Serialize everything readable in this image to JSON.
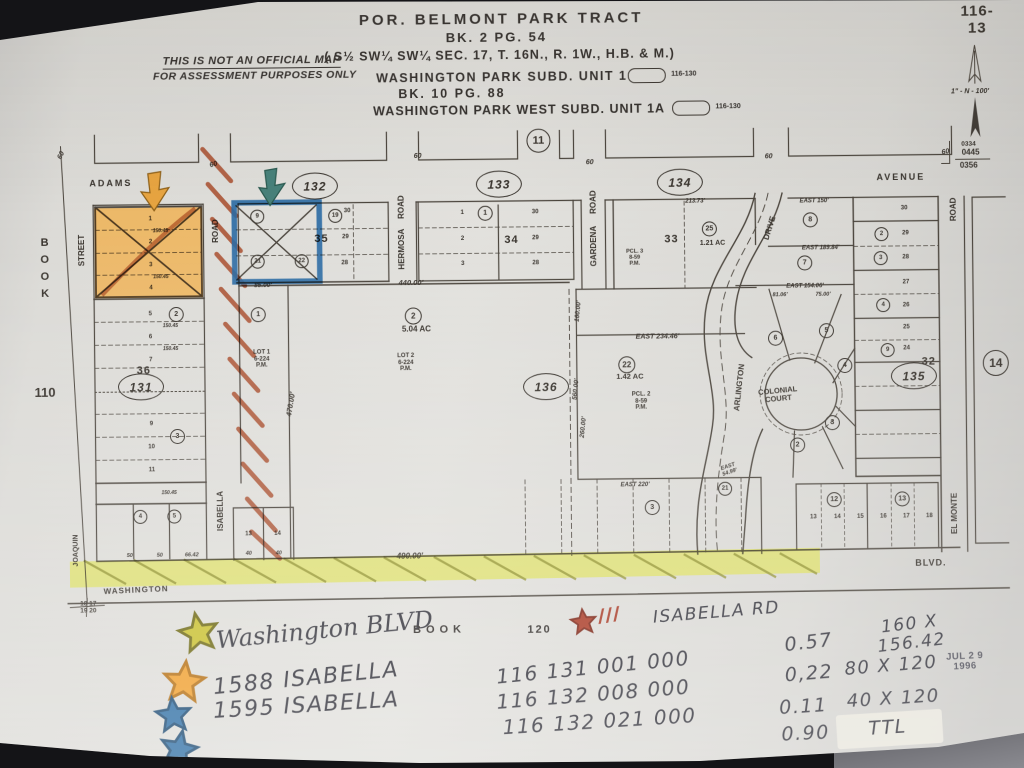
{
  "photo": {
    "background": "#141417",
    "paper_color": "#dcdbd7",
    "highlight_orange": "#f6a21f",
    "highlight_yellow": "#dde13e",
    "marker_blue": "#2b6aa3",
    "marker_red": "#a84c2c"
  },
  "header": {
    "disclaimer_line1": "THIS IS NOT AN OFFICIAL MAP",
    "disclaimer_line2": "FOR ASSESSMENT PURPOSES ONLY",
    "title1": "POR. BELMONT PARK TRACT",
    "title2": "BK. 2 PG. 54",
    "title3": "( S½ SW¼ SW¼ SEC. 17,  T. 16N.,  R. 1W.,  H.B. & M.)",
    "sub1": "WASHINGTON PARK SUBD. UNIT 1",
    "sub1_ref": "116-130",
    "sub2": "BK. 10  PG. 88",
    "sub3": "WASHINGTON PARK WEST SUBD. UNIT 1A",
    "sub3_ref": "116-130",
    "sub4": "BK. 11  PG. 45"
  },
  "map": {
    "texts": [
      {
        "n": "sheet-number",
        "t": "116-13",
        "x": 981,
        "y": 25,
        "s": 15,
        "ls": 1
      },
      {
        "n": "scale-note",
        "t": "1\" - N - 100'",
        "x": 973,
        "y": 97,
        "s": 7,
        "k": "i"
      },
      {
        "n": "ref-0334",
        "t": "0334",
        "x": 971,
        "y": 149,
        "s": 6.5
      },
      {
        "n": "ref-0445",
        "t": "0445",
        "x": 973,
        "y": 158,
        "s": 8
      },
      {
        "n": "ref-0356",
        "t": "0356",
        "x": 971,
        "y": 171,
        "s": 8
      },
      {
        "n": "street-adams",
        "t": "ADAMS",
        "x": 113,
        "y": 180,
        "s": 9,
        "ls": 2
      },
      {
        "n": "street-avenue",
        "t": "AVENUE",
        "x": 903,
        "y": 182,
        "s": 9,
        "ls": 2
      },
      {
        "n": "street-street",
        "t": "STREET",
        "x": 84,
        "y": 246,
        "s": 8,
        "r": -90
      },
      {
        "n": "book-vertical",
        "t": "BOOK",
        "x": 46,
        "y": 266,
        "s": 11,
        "v": 1,
        "ls": 5
      },
      {
        "n": "book-page-110",
        "t": "110",
        "x": 45,
        "y": 388,
        "s": 13
      },
      {
        "n": "street-joaquin",
        "t": "JOAQUIN",
        "x": 75,
        "y": 546,
        "s": 7,
        "r": -90
      },
      {
        "n": "section-corner",
        "t": "18 17\n19 20",
        "x": 86,
        "y": 603,
        "s": 6.5
      },
      {
        "n": "street-isabella",
        "t": "ISABELLA",
        "x": 220,
        "y": 508,
        "s": 8,
        "r": -90
      },
      {
        "n": "road-label-isabella",
        "t": "ROAD",
        "x": 218,
        "y": 228,
        "s": 8,
        "r": -90
      },
      {
        "n": "street-hermosa",
        "t": "HERMOSA",
        "x": 404,
        "y": 248,
        "s": 8,
        "r": -90
      },
      {
        "n": "road-label-hermosa",
        "t": "ROAD",
        "x": 404,
        "y": 206,
        "s": 8,
        "r": -90
      },
      {
        "n": "street-gardena",
        "t": "GARDENA",
        "x": 596,
        "y": 247,
        "s": 8,
        "r": -90
      },
      {
        "n": "road-label-gardena",
        "t": "ROAD",
        "x": 596,
        "y": 203,
        "s": 8,
        "r": -90
      },
      {
        "n": "street-drive",
        "t": "DRIVE",
        "x": 772,
        "y": 231,
        "s": 8,
        "r": -72
      },
      {
        "n": "street-arlington",
        "t": "ARLINGTON",
        "x": 740,
        "y": 390,
        "s": 8,
        "r": -83
      },
      {
        "n": "colonial-court",
        "t": "COLONIAL\nCOURT",
        "x": 778,
        "y": 398,
        "s": 7.5,
        "r": -5
      },
      {
        "n": "street-el-monte",
        "t": "EL MONTE",
        "x": 954,
        "y": 518,
        "s": 8,
        "r": -90
      },
      {
        "n": "road-label-el-monte",
        "t": "ROAD",
        "x": 956,
        "y": 214,
        "s": 8,
        "r": -90
      },
      {
        "n": "street-washington",
        "t": "WASHINGTON",
        "x": 134,
        "y": 587,
        "s": 8,
        "r": -2,
        "ls": 1
      },
      {
        "n": "street-blvd",
        "t": "BLVD.",
        "x": 929,
        "y": 568,
        "s": 9,
        "ls": 1
      },
      {
        "n": "block-36",
        "t": "36",
        "x": 144,
        "y": 367,
        "s": 11,
        "ls": 1
      },
      {
        "n": "block-35",
        "t": "35",
        "x": 323,
        "y": 237,
        "s": 11,
        "ls": 1
      },
      {
        "n": "block-34",
        "t": "34",
        "x": 513,
        "y": 240,
        "s": 11,
        "ls": 1
      },
      {
        "n": "block-33",
        "t": "33",
        "x": 673,
        "y": 241,
        "s": 11,
        "ls": 1
      },
      {
        "n": "block-32",
        "t": "32",
        "x": 929,
        "y": 366,
        "s": 11,
        "ls": 1
      },
      {
        "n": "acreage-504",
        "t": "5.04 AC",
        "x": 417,
        "y": 329,
        "s": 8
      },
      {
        "n": "lot2-label",
        "t": "LOT 2\n6-224\nP.M.",
        "x": 406,
        "y": 362,
        "s": 6
      },
      {
        "n": "lot1-label",
        "t": "LOT 1\n6-224\nP.M.",
        "x": 262,
        "y": 357,
        "s": 6
      },
      {
        "n": "acreage-142",
        "t": "1.42 AC",
        "x": 630,
        "y": 378,
        "s": 7.5
      },
      {
        "n": "pcl2-label",
        "t": "PCL. 2\n8-59\nP.M.",
        "x": 641,
        "y": 403,
        "s": 6
      },
      {
        "n": "pcl3-label",
        "t": "PCL. 3\n8-59\nP.M.",
        "x": 636,
        "y": 259,
        "s": 5.5
      },
      {
        "n": "acreage-121",
        "t": "1.21 AC",
        "x": 714,
        "y": 246,
        "s": 7
      },
      {
        "t": "440.00'",
        "x": 412,
        "y": 282,
        "s": 7.5,
        "k": "i"
      },
      {
        "t": "490.00'",
        "x": 408,
        "y": 556,
        "s": 8,
        "k": "i"
      },
      {
        "t": "85.00'",
        "x": 264,
        "y": 283,
        "s": 6.5,
        "k": "i"
      },
      {
        "t": "470.00'",
        "x": 291,
        "y": 402,
        "s": 7.5,
        "k": "i",
        "r": -80
      },
      {
        "t": "560.00'",
        "x": 576,
        "y": 390,
        "s": 6.5,
        "k": "i",
        "r": -84
      },
      {
        "t": "260.00'",
        "x": 583,
        "y": 428,
        "s": 6.5,
        "k": "i",
        "r": -84
      },
      {
        "t": "160.00'",
        "x": 579,
        "y": 312,
        "s": 6.5,
        "k": "i",
        "r": -84
      },
      {
        "t": "EAST   234.46'",
        "x": 658,
        "y": 339,
        "s": 7,
        "k": "i"
      },
      {
        "t": "EAST  150'",
        "x": 816,
        "y": 205,
        "s": 6,
        "k": "i"
      },
      {
        "t": "EAST 189.84'",
        "x": 822,
        "y": 252,
        "s": 6,
        "k": "i"
      },
      {
        "t": "EAST 154.06'",
        "x": 806,
        "y": 290,
        "s": 6,
        "k": "i"
      },
      {
        "t": "81.06'",
        "x": 781,
        "y": 298,
        "s": 5.5,
        "k": "i"
      },
      {
        "t": "75.00'",
        "x": 824,
        "y": 298,
        "s": 5.5,
        "k": "i"
      },
      {
        "t": "EAST  220'",
        "x": 634,
        "y": 487,
        "s": 6,
        "k": "i"
      },
      {
        "t": "EAST\n54.99'",
        "x": 728,
        "y": 472,
        "s": 5.5,
        "k": "i",
        "r": -18
      },
      {
        "t": "213.73'",
        "x": 697,
        "y": 204,
        "s": 6,
        "k": "i"
      },
      {
        "t": "50",
        "x": 128,
        "y": 552,
        "s": 5.5,
        "k": "i"
      },
      {
        "t": "50",
        "x": 158,
        "y": 552,
        "s": 5.5,
        "k": "i"
      },
      {
        "t": "66.42",
        "x": 190,
        "y": 552,
        "s": 5.5,
        "k": "i"
      },
      {
        "t": "40",
        "x": 247,
        "y": 551,
        "s": 5.5,
        "k": "i"
      },
      {
        "t": "40",
        "x": 277,
        "y": 551,
        "s": 5.5,
        "k": "i"
      },
      {
        "t": "60",
        "x": 64,
        "y": 151,
        "s": 7,
        "k": "i",
        "r": -62
      },
      {
        "t": "60",
        "x": 216,
        "y": 162,
        "s": 7,
        "k": "i",
        "r": -15
      },
      {
        "t": "60",
        "x": 420,
        "y": 156,
        "s": 7,
        "k": "i"
      },
      {
        "t": "60",
        "x": 592,
        "y": 164,
        "s": 7,
        "k": "i"
      },
      {
        "t": "60",
        "x": 771,
        "y": 160,
        "s": 7,
        "k": "i"
      },
      {
        "t": "60",
        "x": 948,
        "y": 157,
        "s": 7,
        "k": "i",
        "r": -10
      },
      {
        "t": "150.45",
        "x": 162,
        "y": 228,
        "s": 5,
        "k": "i"
      },
      {
        "t": "150.45",
        "x": 162,
        "y": 274,
        "s": 5,
        "k": "i"
      },
      {
        "t": "150.45",
        "x": 171,
        "y": 323,
        "s": 5,
        "k": "i"
      },
      {
        "t": "150.45",
        "x": 171,
        "y": 346,
        "s": 5,
        "k": "i"
      },
      {
        "t": "150.45",
        "x": 168,
        "y": 490,
        "s": 5,
        "k": "i"
      },
      {
        "t": "1",
        "x": 152,
        "y": 216,
        "s": 6,
        "k": "n"
      },
      {
        "t": "2",
        "x": 152,
        "y": 239,
        "s": 6,
        "k": "n"
      },
      {
        "t": "3",
        "x": 152,
        "y": 262,
        "s": 6,
        "k": "n"
      },
      {
        "t": "4",
        "x": 152,
        "y": 285,
        "s": 6,
        "k": "n"
      },
      {
        "t": "5",
        "x": 151,
        "y": 311,
        "s": 6,
        "k": "n"
      },
      {
        "t": "6",
        "x": 151,
        "y": 334,
        "s": 6,
        "k": "n"
      },
      {
        "t": "7",
        "x": 151,
        "y": 357,
        "s": 6,
        "k": "n"
      },
      {
        "t": "9",
        "x": 151,
        "y": 421,
        "s": 6,
        "k": "n"
      },
      {
        "t": "10",
        "x": 151,
        "y": 444,
        "s": 6,
        "k": "n"
      },
      {
        "t": "11",
        "x": 151,
        "y": 467,
        "s": 6,
        "k": "n"
      },
      {
        "t": "30",
        "x": 349,
        "y": 210,
        "s": 6,
        "k": "n"
      },
      {
        "t": "29",
        "x": 347,
        "y": 236,
        "s": 6,
        "k": "n"
      },
      {
        "t": "28",
        "x": 346,
        "y": 262,
        "s": 6,
        "k": "n"
      },
      {
        "t": "1",
        "x": 464,
        "y": 213,
        "s": 6,
        "k": "n"
      },
      {
        "t": "2",
        "x": 464,
        "y": 239,
        "s": 6,
        "k": "n"
      },
      {
        "t": "3",
        "x": 464,
        "y": 264,
        "s": 6,
        "k": "n"
      },
      {
        "t": "30",
        "x": 537,
        "y": 213,
        "s": 6,
        "k": "n"
      },
      {
        "t": "29",
        "x": 537,
        "y": 239,
        "s": 6,
        "k": "n"
      },
      {
        "t": "28",
        "x": 537,
        "y": 264,
        "s": 6,
        "k": "n"
      },
      {
        "t": "30",
        "x": 906,
        "y": 213,
        "s": 6,
        "k": "n"
      },
      {
        "t": "29",
        "x": 907,
        "y": 238,
        "s": 6,
        "k": "n"
      },
      {
        "t": "28",
        "x": 907,
        "y": 262,
        "s": 6,
        "k": "n"
      },
      {
        "t": "27",
        "x": 907,
        "y": 287,
        "s": 6,
        "k": "n"
      },
      {
        "t": "26",
        "x": 907,
        "y": 310,
        "s": 6,
        "k": "n"
      },
      {
        "t": "25",
        "x": 907,
        "y": 332,
        "s": 6,
        "k": "n"
      },
      {
        "t": "24",
        "x": 907,
        "y": 353,
        "s": 6,
        "k": "n"
      },
      {
        "t": "13",
        "x": 812,
        "y": 521,
        "s": 6,
        "k": "n"
      },
      {
        "t": "14",
        "x": 836,
        "y": 521,
        "s": 6,
        "k": "n"
      },
      {
        "t": "15",
        "x": 859,
        "y": 521,
        "s": 6,
        "k": "n"
      },
      {
        "t": "16",
        "x": 882,
        "y": 521,
        "s": 6,
        "k": "n"
      },
      {
        "t": "17",
        "x": 905,
        "y": 521,
        "s": 6,
        "k": "n"
      },
      {
        "t": "18",
        "x": 928,
        "y": 521,
        "s": 6,
        "k": "n"
      },
      {
        "t": "13",
        "x": 247,
        "y": 532,
        "s": 6,
        "k": "n"
      },
      {
        "t": "14",
        "x": 276,
        "y": 532,
        "s": 6,
        "k": "n"
      }
    ],
    "ellipses": [
      {
        "t": "131",
        "x": 141,
        "y": 383
      },
      {
        "t": "132",
        "x": 317,
        "y": 184
      },
      {
        "t": "133",
        "x": 501,
        "y": 184
      },
      {
        "t": "134",
        "x": 682,
        "y": 184
      },
      {
        "t": "135",
        "x": 914,
        "y": 380
      },
      {
        "t": "136",
        "x": 546,
        "y": 387
      }
    ],
    "circles": [
      {
        "t": "11",
        "x": 541,
        "y": 141,
        "d": 22
      },
      {
        "t": "14",
        "x": 996,
        "y": 368,
        "d": 24
      },
      {
        "t": "1",
        "x": 487,
        "y": 213,
        "d": 13
      },
      {
        "t": "1",
        "x": 259,
        "y": 312,
        "d": 13
      },
      {
        "t": "2",
        "x": 414,
        "y": 315,
        "d": 15
      },
      {
        "t": "22",
        "x": 627,
        "y": 366,
        "d": 15
      },
      {
        "t": "25",
        "x": 711,
        "y": 231,
        "d": 13
      },
      {
        "t": "2",
        "x": 177,
        "y": 311,
        "d": 13
      },
      {
        "t": "3",
        "x": 177,
        "y": 433,
        "d": 13
      },
      {
        "t": "4",
        "x": 139,
        "y": 513,
        "d": 12
      },
      {
        "t": "5",
        "x": 173,
        "y": 513,
        "d": 12
      },
      {
        "t": "9",
        "x": 259,
        "y": 214,
        "d": 12
      },
      {
        "t": "21",
        "x": 259,
        "y": 259,
        "d": 12
      },
      {
        "t": "22",
        "x": 303,
        "y": 259,
        "d": 12
      },
      {
        "t": "19",
        "x": 337,
        "y": 214,
        "d": 12
      },
      {
        "t": "3",
        "x": 651,
        "y": 509,
        "d": 13
      },
      {
        "t": "21",
        "x": 724,
        "y": 491,
        "d": 12
      },
      {
        "t": "12",
        "x": 833,
        "y": 503,
        "d": 13
      },
      {
        "t": "13",
        "x": 901,
        "y": 503,
        "d": 13
      },
      {
        "t": "8",
        "x": 812,
        "y": 223,
        "d": 13
      },
      {
        "t": "7",
        "x": 806,
        "y": 266,
        "d": 13
      },
      {
        "t": "6",
        "x": 776,
        "y": 341,
        "d": 13
      },
      {
        "t": "5",
        "x": 827,
        "y": 334,
        "d": 13
      },
      {
        "t": "4",
        "x": 845,
        "y": 369,
        "d": 13
      },
      {
        "t": "3",
        "x": 832,
        "y": 426,
        "d": 13
      },
      {
        "t": "2",
        "x": 797,
        "y": 448,
        "d": 13
      },
      {
        "t": "2",
        "x": 883,
        "y": 238,
        "d": 12
      },
      {
        "t": "3",
        "x": 882,
        "y": 262,
        "d": 12
      },
      {
        "t": "4",
        "x": 884,
        "y": 309,
        "d": 12
      },
      {
        "t": "9",
        "x": 888,
        "y": 354,
        "d": 12
      }
    ]
  },
  "annotations": {
    "texts": [
      {
        "n": "hand-washington-blvd",
        "t": "Washington BLVD",
        "x": 322,
        "y": 628,
        "s": 24,
        "k": "h",
        "r": -5
      },
      {
        "n": "print-book",
        "t": "BOOK",
        "x": 437,
        "y": 629,
        "s": 11,
        "k": "t",
        "ls": 5
      },
      {
        "n": "print-book-number",
        "t": "120",
        "x": 537,
        "y": 630,
        "s": 11,
        "k": "t",
        "ls": 2
      },
      {
        "n": "hand-tally-111",
        "t": "///",
        "x": 607,
        "y": 617,
        "s": 20,
        "k": "rh",
        "r": -8
      },
      {
        "n": "hand-isabella-rd",
        "t": "ISABELLA RD",
        "x": 714,
        "y": 615,
        "s": 17,
        "k": "hc",
        "r": -4
      },
      {
        "n": "hand-acres-1",
        "t": "0.57",
        "x": 806,
        "y": 646,
        "s": 19,
        "k": "hc",
        "r": -6
      },
      {
        "n": "hand-size-1",
        "t": "160 X 156.42",
        "x": 908,
        "y": 638,
        "s": 17,
        "k": "hc",
        "r": -6
      },
      {
        "n": "hand-address-1",
        "t": "1588 ISABELLA",
        "x": 303,
        "y": 677,
        "s": 22,
        "k": "hc",
        "r": -5
      },
      {
        "n": "hand-apn-1",
        "t": "116 131 001 000",
        "x": 590,
        "y": 668,
        "s": 20,
        "k": "hc",
        "r": -5
      },
      {
        "n": "hand-address-2",
        "t": "1595 ISABELLA",
        "x": 303,
        "y": 704,
        "s": 22,
        "k": "hc",
        "r": -3
      },
      {
        "n": "hand-apn-2",
        "t": "116 132 008 000",
        "x": 590,
        "y": 695,
        "s": 20,
        "k": "hc",
        "r": -4
      },
      {
        "n": "hand-acres-2",
        "t": "0,22",
        "x": 806,
        "y": 677,
        "s": 19,
        "k": "hc",
        "r": -4
      },
      {
        "n": "hand-size-2",
        "t": "80 X 120",
        "x": 888,
        "y": 670,
        "s": 18,
        "k": "hc",
        "r": -4
      },
      {
        "n": "hand-apn-3",
        "t": "116 132 021 000",
        "x": 596,
        "y": 722,
        "s": 20,
        "k": "hc",
        "r": -3
      },
      {
        "n": "hand-acres-3",
        "t": "0.11",
        "x": 800,
        "y": 710,
        "s": 19,
        "k": "hc",
        "r": -3
      },
      {
        "n": "hand-size-3",
        "t": "40 X 120",
        "x": 890,
        "y": 703,
        "s": 18,
        "k": "hc",
        "r": -3
      },
      {
        "n": "hand-acres-total",
        "t": "0.90",
        "x": 802,
        "y": 737,
        "s": 19,
        "k": "hc",
        "r": -2
      },
      {
        "n": "hand-total-label",
        "t": "TTL",
        "x": 884,
        "y": 732,
        "s": 19,
        "k": "hc",
        "r": -3
      },
      {
        "n": "date-stamp",
        "t": "JUL 2 9 1996",
        "x": 962,
        "y": 667,
        "s": 9.5,
        "k": "st",
        "r": -2
      }
    ]
  }
}
